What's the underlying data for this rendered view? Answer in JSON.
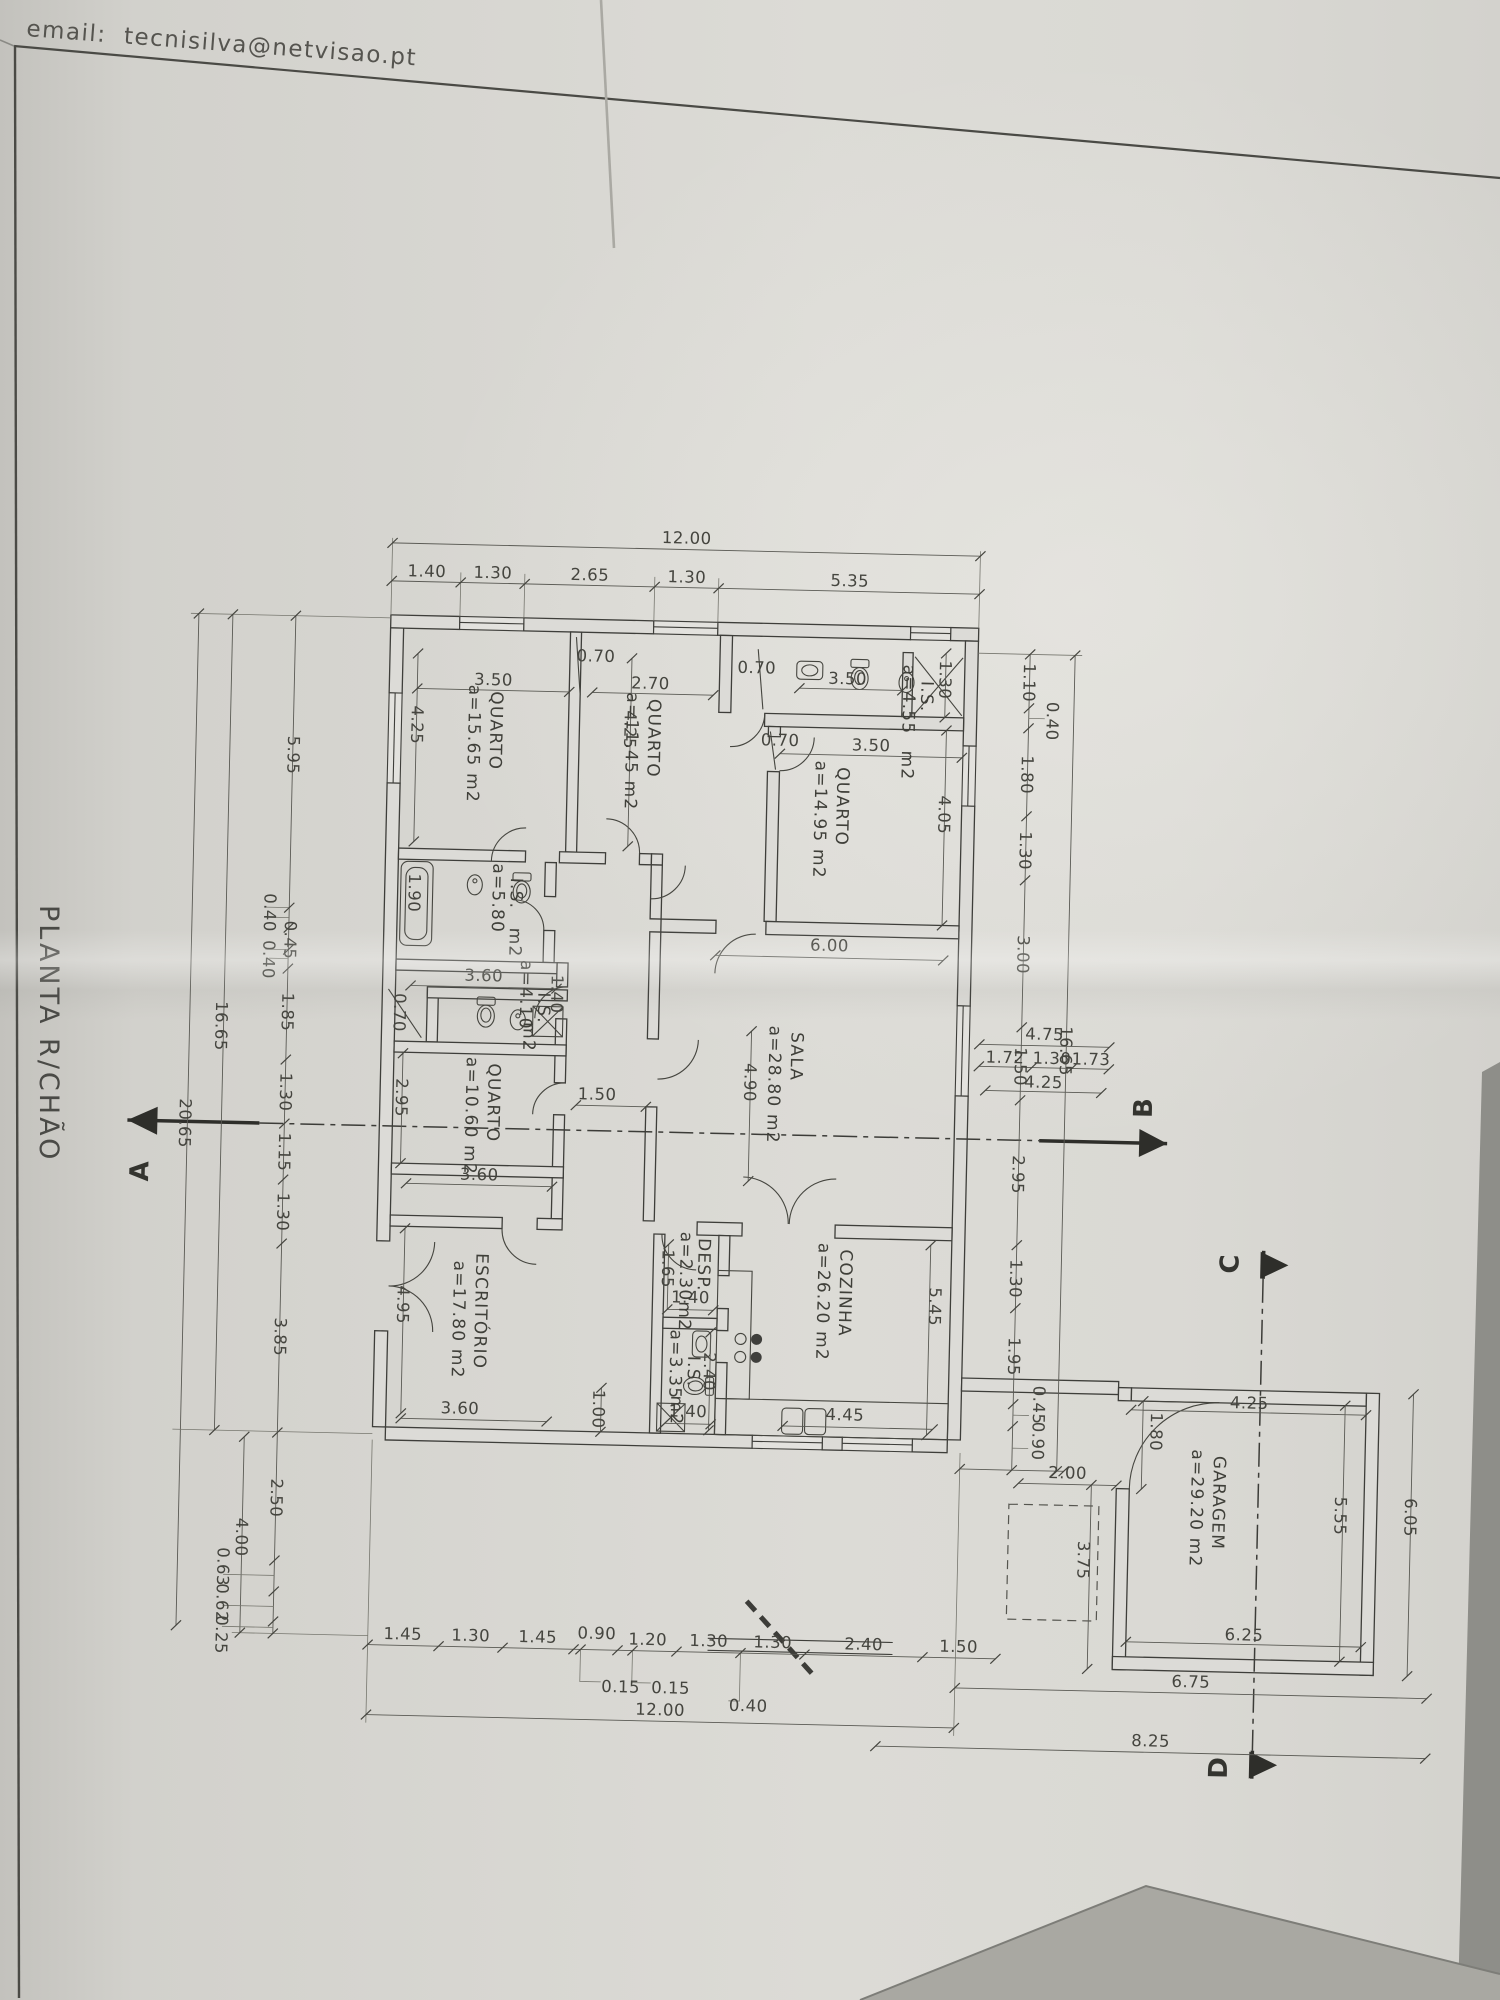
{
  "photo": {
    "email_line": "email:  tecnisilva@netvisao.pt",
    "title": "PLANTA R/CHÃO"
  },
  "rooms": {
    "quarto1": {
      "name": "QUARTO",
      "area": "a=15.65 m2"
    },
    "quarto2": {
      "name": "QUARTO",
      "area": "a=11.45 m2"
    },
    "quarto3": {
      "name": "QUARTO",
      "area": "a=14.95 m2"
    },
    "quarto4": {
      "name": "QUARTO",
      "area": "a=10.60 m2"
    },
    "sala": {
      "name": "SALA",
      "area": "a=28.80 m2"
    },
    "escritorio": {
      "name": "ESCRITÓRIO",
      "area": "a=17.80 m2"
    },
    "cozinha": {
      "name": "COZINHA",
      "area": "a=26.20 m2"
    },
    "garagem": {
      "name": "GARAGEM",
      "area": "a=29.20 m2"
    },
    "is_top": {
      "name": "I.S.",
      "area": "a=4.55",
      "unit": "m2",
      "width_dim": "1.30"
    },
    "is_main": {
      "name": "I.S.",
      "area": "a=5.80",
      "unit": "m2"
    },
    "is_small": {
      "name": "I.S.",
      "area": "a=4.10",
      "unit": "m2",
      "width_dim": "1.40"
    },
    "is_kitchen": {
      "name": "I.S.",
      "area": "a=3.35",
      "unit": "m2"
    },
    "desp": {
      "name": "DESP.",
      "area": "a=2.30m2"
    }
  },
  "dims": {
    "top_total": "12.00",
    "top_chain": [
      "1.40",
      "1.30",
      "2.65",
      "1.30",
      "5.35"
    ],
    "bottom_total": "12.00",
    "bottom_chain": [
      "1.45",
      "1.30",
      "1.45",
      "0.90",
      "1.20",
      "1.30",
      "1.30",
      "2.40",
      "1.50"
    ],
    "bottom_sub": [
      "0.15",
      "0.15",
      "0.40"
    ],
    "left_chain": [
      "5.95",
      "0.40",
      "0.45",
      "0.40",
      "1.85",
      "1.30",
      "1.15",
      "1.30",
      "3.85"
    ],
    "left_total": "16.65",
    "left_overall": "20.65",
    "left_lower": [
      "2.50",
      "0.63",
      "0.62",
      "0.25"
    ],
    "left_lower_total": "4.00",
    "right_chain": [
      "1.10",
      "0.40",
      "1.80",
      "1.30",
      "3.00",
      "1.50",
      "2.95",
      "1.30",
      "1.95",
      "0.45",
      "0.90"
    ],
    "right_total": "16.65",
    "porch_total": "4.75",
    "porch_chain": [
      "1.72",
      "1.30",
      "1.73"
    ],
    "porch_overall": "4.25",
    "q1_w": "3.50",
    "q1_h": "4.25",
    "q2_w": "2.70",
    "q2_h": "4.25",
    "is_top_w": "3.50",
    "q3_w": "3.50",
    "q3_h": "4.05",
    "bath_tub": "1.90",
    "is_main_b": "3.60",
    "q4_w": "3.60",
    "q4_h": "2.95",
    "hall_w": "1.50",
    "sala_w": "6.00",
    "sala_h": "4.90",
    "esc_h": "4.95",
    "esc_w": "3.60",
    "esc_pass": "1.00",
    "desp_h": "1.65",
    "desp_w": "1.40",
    "is_k_h": "2.40",
    "is_k_w": "1.40",
    "coz_h": "5.45",
    "coz_w": "4.45",
    "door1": "0.70",
    "door2": "0.70",
    "door3": "0.70",
    "door4": "0.70",
    "gar_top": "4.25",
    "gar_door": "1.80",
    "gar_gap": "2.00",
    "gar_side": "3.75",
    "gar_h": "5.55",
    "gar_b": "6.25",
    "gar_out": "6.05",
    "br_total1": "6.75",
    "br_total2": "8.25"
  },
  "sections": {
    "a": "A",
    "b": "B",
    "c": "C",
    "d": "D"
  }
}
